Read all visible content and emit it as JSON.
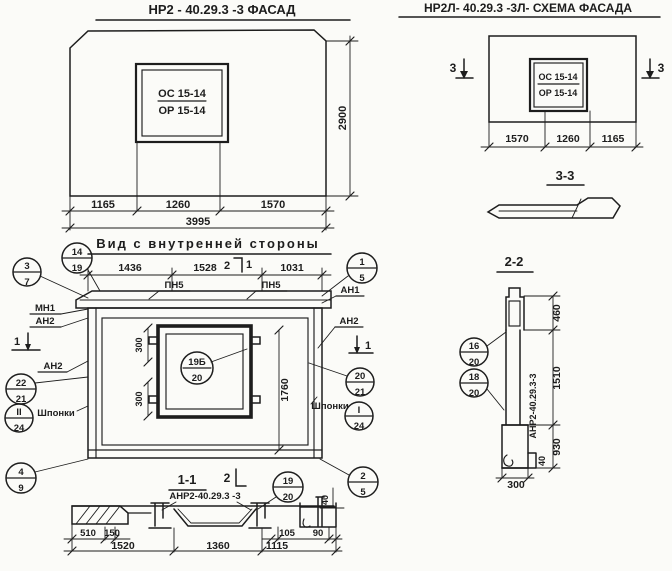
{
  "facade": {
    "title": "НР2 - 40.29.3 -3 ФАСАД",
    "window_label_top": "ОС 15-14",
    "window_label_bottom": "ОР 15-14",
    "dim_height": "2900",
    "dims": [
      "1165",
      "1260",
      "1570"
    ],
    "dim_total": "3995"
  },
  "schema": {
    "title": "НР2Л- 40.29.3 -3Л- СХЕМА ФАСАДА",
    "window_label_top": "ОС 15-14",
    "window_label_bottom": "ОР 15-14",
    "section_mark": "3",
    "dims": [
      "1570",
      "1260",
      "1165"
    ],
    "section_3_3_title": "3-3"
  },
  "inner_view": {
    "title": "Вид с внутренней стороны",
    "dims_top": [
      "1436",
      "1528",
      "1031"
    ],
    "pn_label": "ПН5",
    "mark_2": "2",
    "mark_1": "1",
    "label_mn1": "МН1",
    "label_an1": "АН1",
    "label_an2": "АН2",
    "label_shponki": "Шпонки",
    "dim_300": "300",
    "dim_1760": "1760",
    "dim_40": "40",
    "callouts": {
      "c3_7": {
        "top": "3",
        "bottom": "7"
      },
      "c14_19": {
        "top": "14",
        "bottom": "19"
      },
      "c22_21": {
        "top": "22",
        "bottom": "21"
      },
      "c11_24": {
        "top": "II",
        "bottom": "24"
      },
      "c4_9": {
        "top": "4",
        "bottom": "9"
      },
      "c1_5": {
        "top": "1",
        "bottom": "5"
      },
      "c20_21": {
        "top": "20",
        "bottom": "21"
      },
      "c1_24": {
        "top": "I",
        "bottom": "24"
      },
      "c2_5": {
        "top": "2",
        "bottom": "5"
      },
      "c19b_20": {
        "top": "19Б",
        "bottom": "20"
      }
    }
  },
  "section_1_1": {
    "title": "1-1",
    "mark_2": "2",
    "label": "АНР2-40.29.3 -3",
    "callout": {
      "top": "19",
      "bottom": "20"
    },
    "dims_upper": [
      "510",
      "150",
      "105",
      "90"
    ],
    "dims_lower": [
      "1520",
      "1360",
      "1115"
    ]
  },
  "section_2_2": {
    "title": "2-2",
    "label_rotated": "АНР2-40.29.3-3",
    "dim_460": "460",
    "dim_1510": "1510",
    "dim_930": "930",
    "dim_40": "40",
    "dim_300": "300",
    "callouts": {
      "c16_20": {
        "top": "16",
        "bottom": "20"
      },
      "c18_20": {
        "top": "18",
        "bottom": "20"
      }
    }
  }
}
